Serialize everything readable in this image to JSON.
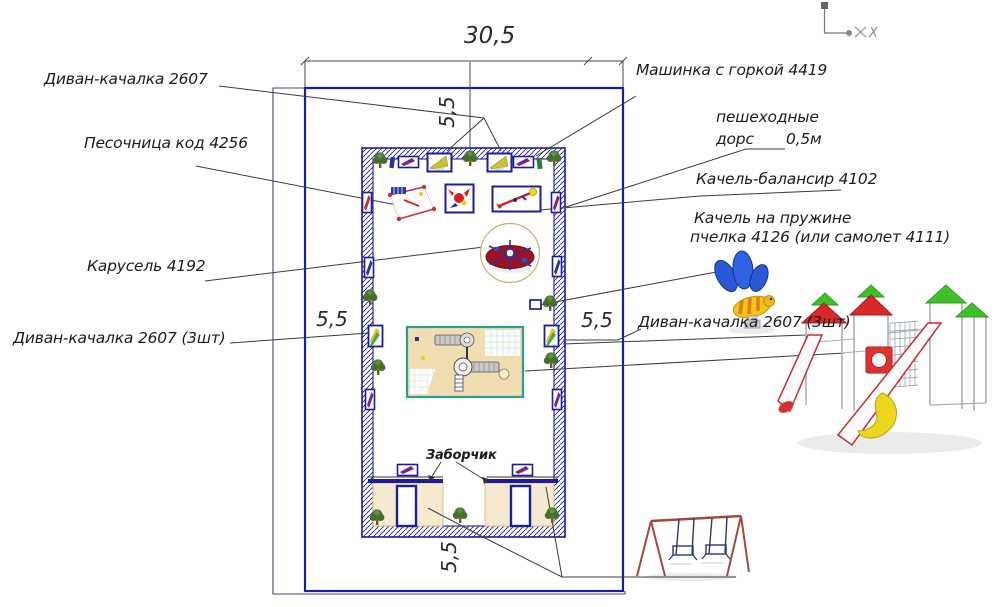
{
  "drawing": {
    "type": "playground layout plan (CAD annotation drawing)",
    "labels": {
      "divan_top": "Диван-качалка 2607",
      "sandbox": "Песочница код 4256",
      "carousel": "Карусель 4192",
      "divan_left": "Диван-качалка 2607 (3шт)",
      "car_slide": "Машинка с горкой 4419",
      "paths_word1": "пешеходные",
      "paths_word2": "дорс",
      "paths_value": "0,5м",
      "seesaw": "Качель-балансир 4102",
      "spring_row1": "Качель на пружине",
      "spring_row2": "пчелка 4126 (или самолет 4111)",
      "divan_right": "Диван-качалка 2607 (3шт)",
      "fence": "Заборчик"
    },
    "dimensions": {
      "top_width": "30,5",
      "top_offset": "5,5",
      "left_side": "5,5",
      "right_side": "5,5",
      "bottom": "5,5"
    },
    "axis": {
      "x": "X"
    },
    "icons": {
      "axis": "xy-axis-icon",
      "tree": "tree-icon",
      "bench": "bench-top-view-icon",
      "canopy_swing": "canopy-sofa-swing-icon",
      "sandbox": "sandbox-icon",
      "spring_rocker": "spring-rocker-icon",
      "seesaw": "seesaw-icon",
      "carousel": "carousel-icon",
      "play_complex": "play-complex-plan-icon"
    },
    "colors": {
      "line_blue": "#1c1c9c",
      "leader_gray": "#3c3c3c",
      "tan": "#f1e2bd",
      "teal_border": "#28a094",
      "canopy_yellow": "#c9c32f",
      "tree_green": "#4f7d32",
      "bench_purple": "#7a2090",
      "accent_red": "#d02020"
    }
  }
}
